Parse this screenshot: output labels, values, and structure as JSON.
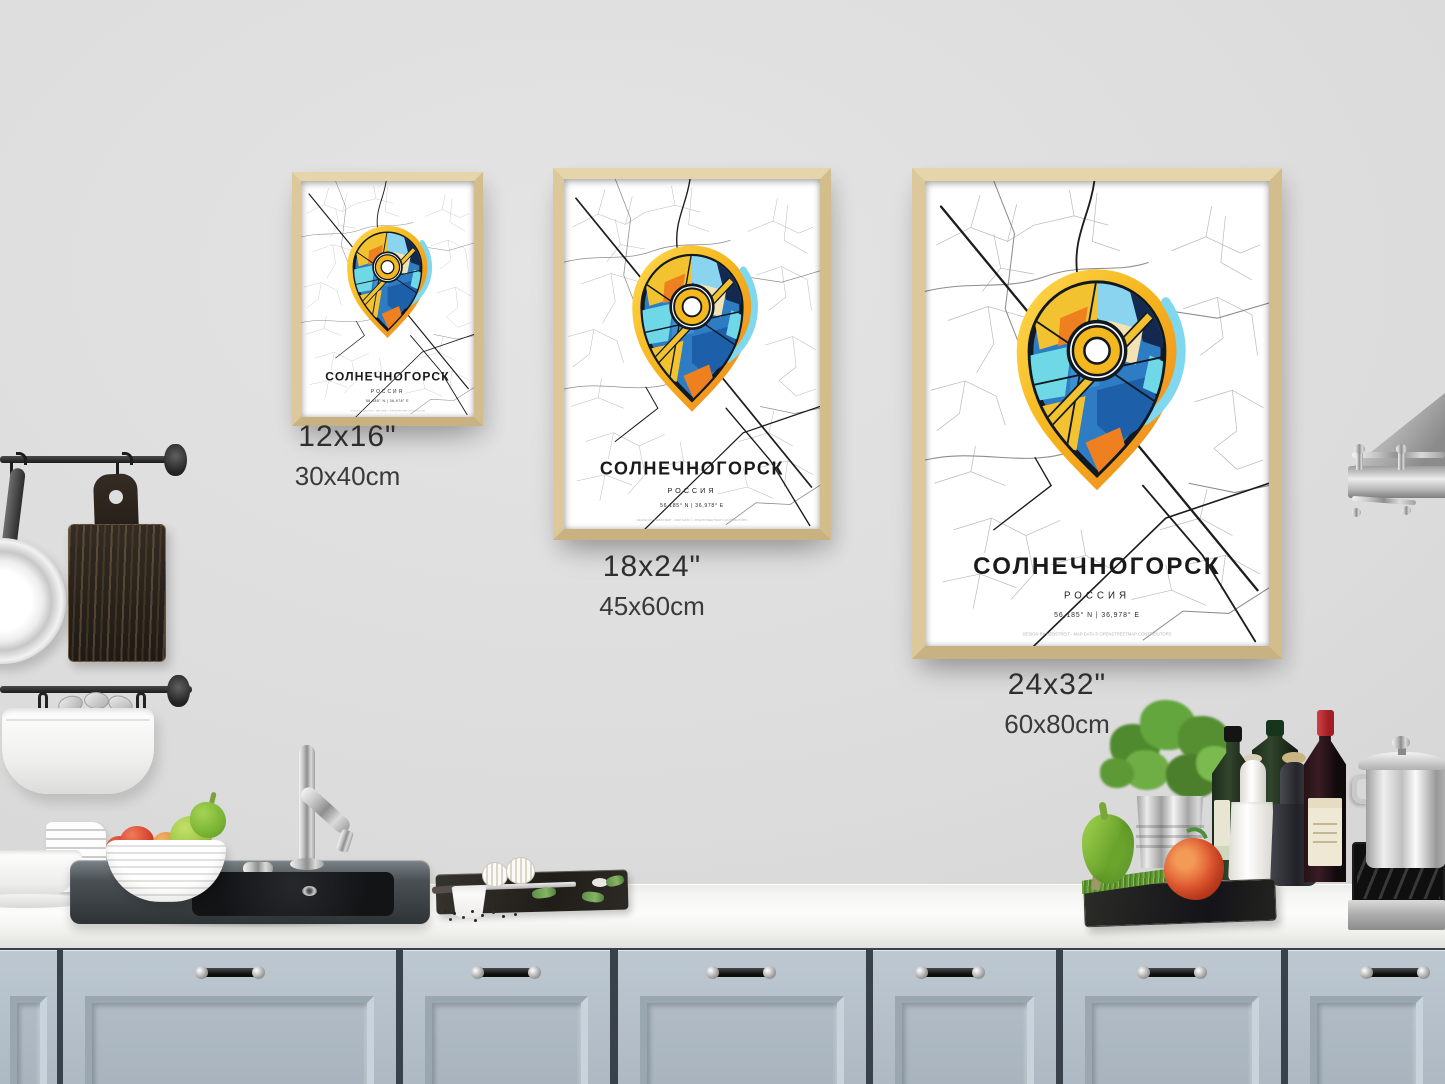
{
  "scene": {
    "description": "Kitchen wall mockup with three framed city map posters above a counter",
    "wall_color": "#dcdcdc",
    "cabinet_color": "#b5c0c9",
    "countertop_color": "#f4f4f1",
    "frame_wood_color": "#d9c59b"
  },
  "poster": {
    "title": "СОЛНЕЧНОГОРСК",
    "subtitle": "РОССИЯ",
    "coordinates": "56,185° N | 36,978° E",
    "credit": "DESIGN BY HEBSTREIT · MAP DATA © OPENSTREETMAP CONTRIBUTORS",
    "pin_colors": {
      "yellow": "#f2c230",
      "orange": "#ef8020",
      "light_blue": "#8ad4f0",
      "cyan": "#6fd8e6",
      "blue": "#1d5fa8",
      "navy": "#14294f",
      "outline": "#101820"
    },
    "road_color": "#1c1c1c",
    "street_color": "#b9b9b9"
  },
  "size_labels": [
    {
      "inches": "12x16\"",
      "cm": "30x40cm"
    },
    {
      "inches": "18x24\"",
      "cm": "45x60cm"
    },
    {
      "inches": "24x32\"",
      "cm": "60x80cm"
    }
  ]
}
